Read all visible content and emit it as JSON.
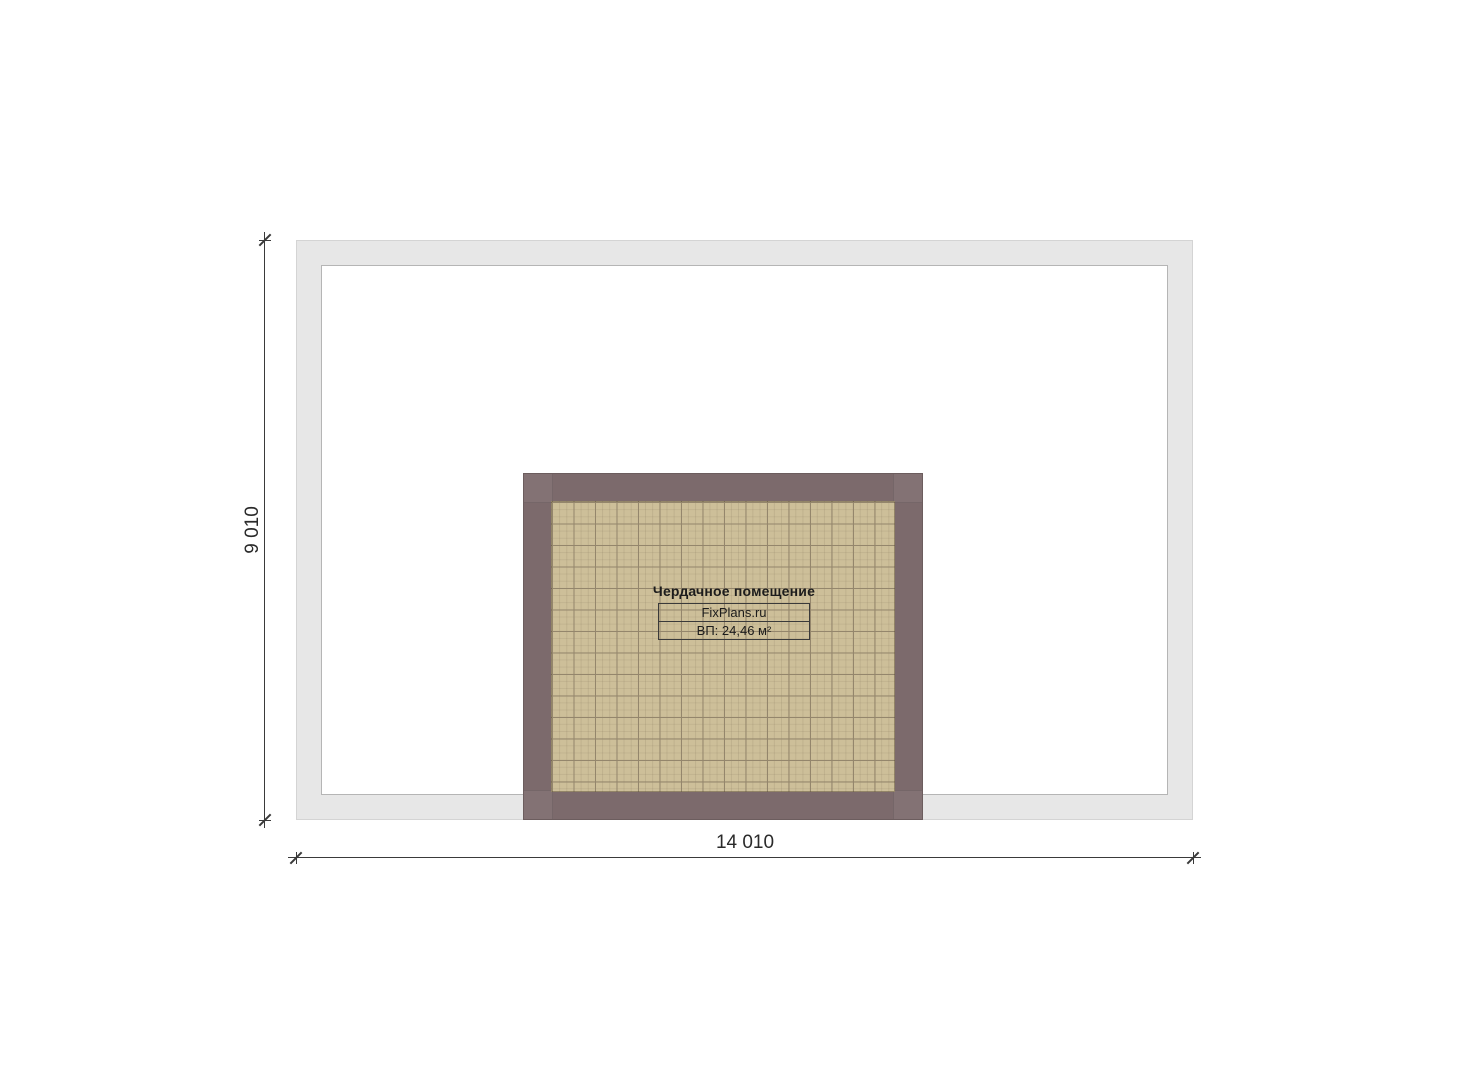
{
  "plan": {
    "room": {
      "title": "Чердачное помещение",
      "brand": "FixPlans.ru",
      "area": "ВП: 24,46 м²"
    },
    "dimensions": {
      "height": "9 010",
      "width": "14 010"
    },
    "colors": {
      "outer_wall_fill": "#e7e7e7",
      "outer_wall_edge": "#b5b5b5",
      "outer_wall_edge_light": "#d4d4d4",
      "attic_wall_fill": "#7c6a6c",
      "floor_fill": "#cdbf99",
      "floor_grid_line": "#94866c",
      "dim_color": "#3a3a3a",
      "label_text": "#1c1c1c"
    }
  }
}
